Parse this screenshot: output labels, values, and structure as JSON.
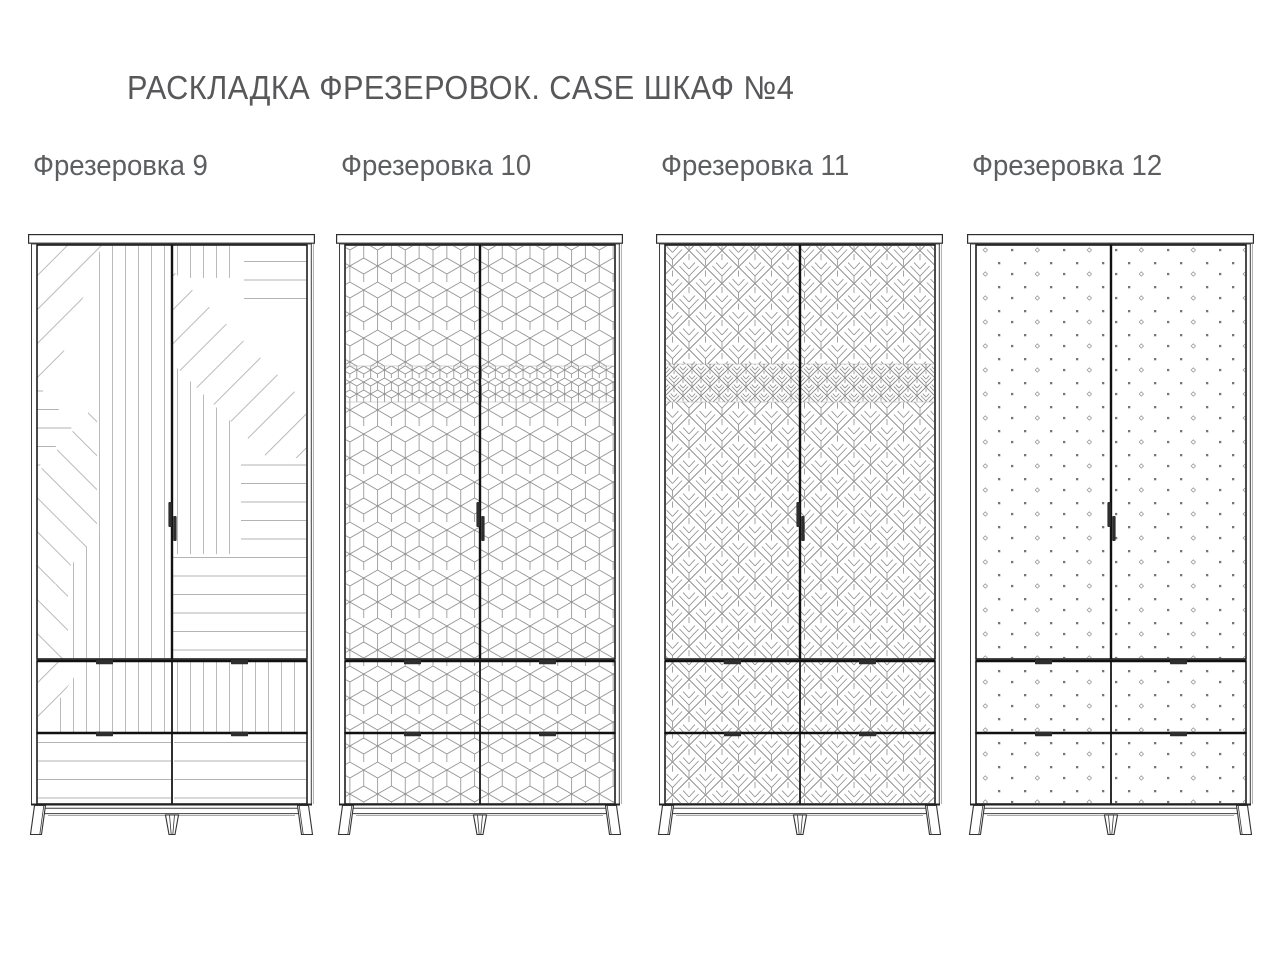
{
  "title": "РАСКЛАДКА ФРЕЗЕРОВОК. CASE ШКАФ №4",
  "wardrobes": [
    {
      "label": "Фрезеровка 9",
      "pattern": "diagonal-composition"
    },
    {
      "label": "Фрезеровка 10",
      "pattern": "isometric-cubes"
    },
    {
      "label": "Фрезеровка 11",
      "pattern": "chevron-leaves"
    },
    {
      "label": "Фрезеровка 12",
      "pattern": "dot-grid"
    }
  ],
  "colors": {
    "background": "#ffffff",
    "title_text": "#58585a",
    "label_text": "#5d5e60",
    "outline": "#1d1d1d",
    "frame": "#3f3f3f",
    "divider": "#111111",
    "handle": "#2e2e2e",
    "pattern_line": "#b3b3b3",
    "pattern_mid": "#8e8e8e",
    "dot_fill": "#767676",
    "dot_outline": "#9a9a9a"
  }
}
